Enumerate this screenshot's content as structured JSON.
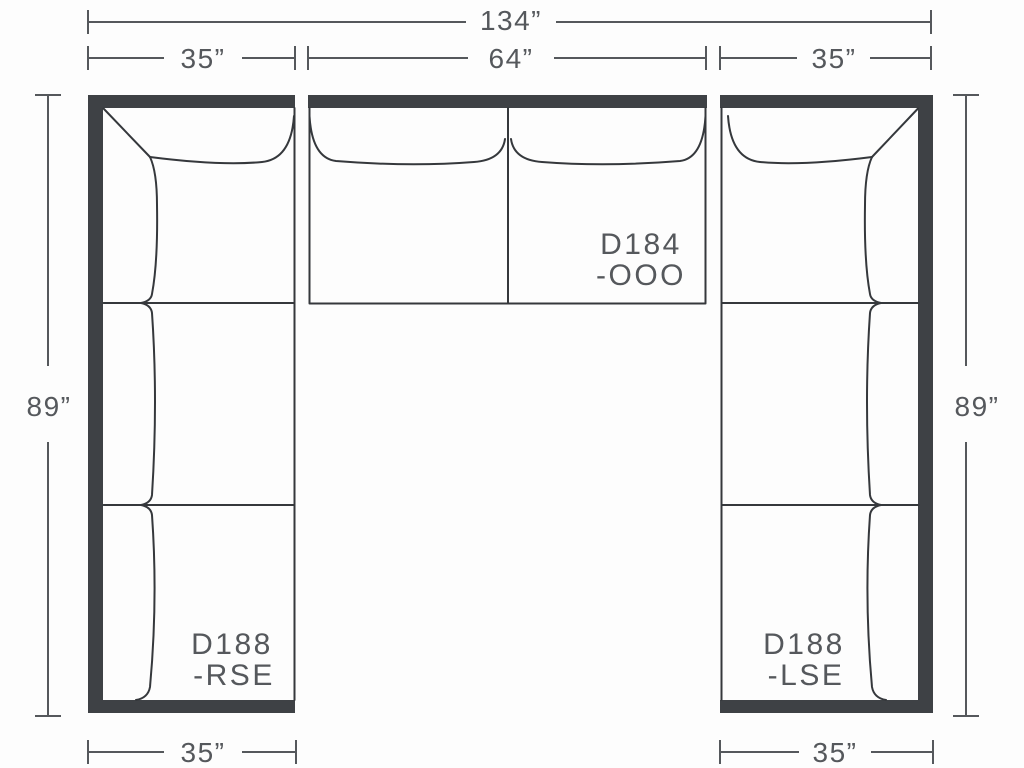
{
  "diagram": {
    "type": "sectional-sofa-floorplan",
    "colors": {
      "background": "#fdfdfd",
      "frame": "#3e4145",
      "line": "#35383c",
      "dimension": "#55585c",
      "text": "#55585c"
    },
    "dimensions": {
      "total_width": "134”",
      "left_width": "35”",
      "middle_width": "64”",
      "right_width": "35”",
      "left_height": "89”",
      "right_height": "89”",
      "bottom_left_width": "35”",
      "bottom_right_width": "35”"
    },
    "units": {
      "left": {
        "model": "D188",
        "variant": "-RSE"
      },
      "middle": {
        "model": "D184",
        "variant": "-OOO"
      },
      "right": {
        "model": "D188",
        "variant": "-LSE"
      }
    }
  }
}
